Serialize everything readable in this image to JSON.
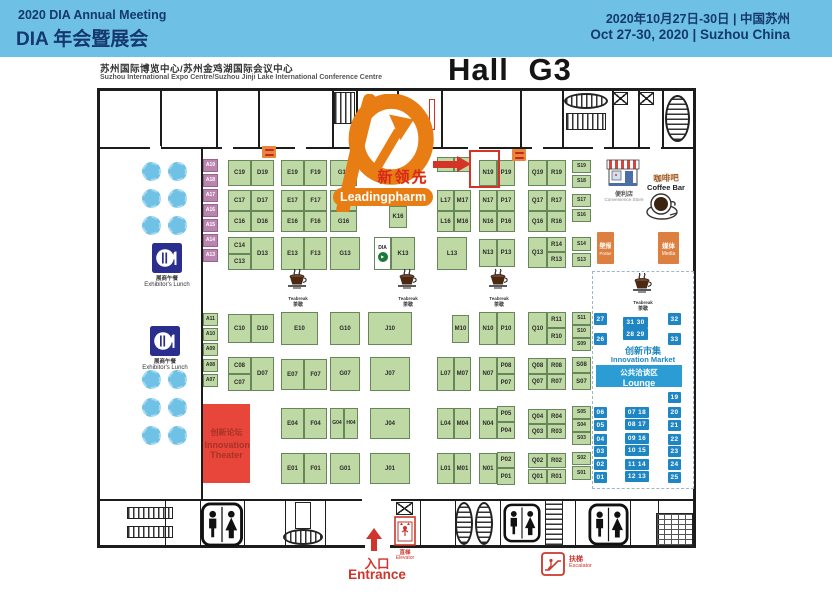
{
  "header": {
    "title_en": "2020 DIA Annual Meeting",
    "title_cn": "DIA 年会暨展会",
    "date_cn": "2020年10月27日-30日 | 中国苏州",
    "date_en": "Oct 27-30, 2020 | Suzhou China",
    "bg_color": "#6EC1E4",
    "text_color": "#14386F"
  },
  "venue": {
    "line_cn": "苏州国际博览中心/苏州金鸡湖国际会议中心",
    "line_en": "Suzhou International Expo Centre/Suzhou Jinji Lake International Conference Centre",
    "hall": "Hall G3"
  },
  "logo": {
    "brand_cn": "新领先",
    "brand_en": "Leadingpharm",
    "accent": "#E87D13"
  },
  "highlight_booth": "N19",
  "labels": {
    "lunch_cn": "展商午餐",
    "lunch_en": "Exhibitor's Lunch",
    "teabreak_en": "Teabreak",
    "teabreak_cn": "茶歇",
    "store_cn": "便利店",
    "store_en": "Convenience Store",
    "coffee_cn": "咖啡吧",
    "coffee_en": "Coffee Bar",
    "poster_cn": "壁报",
    "poster_en": "Poster",
    "media_cn": "媒体",
    "media_en": "Media",
    "market_cn": "创新市集",
    "market_en": "Innovation Market",
    "lounge_cn": "公共洽谈区",
    "lounge_en": "Lounge",
    "theater_cn": "创新论坛",
    "theater_en": "Innovation Theater",
    "entrance_cn": "入口",
    "entrance_en": "Entrance",
    "elevator_cn": "直梯",
    "elevator_en": "Elevator",
    "escalator_cn": "扶梯",
    "escalator_en": "Escalator"
  },
  "colors": {
    "booth_green": "#BED9A4",
    "booth_purple": "#BA85B0",
    "stall_blue": "#1E86C2",
    "lounge_blue": "#2C9DD4",
    "service_orange": "#DD7F3F",
    "theater_red": "#E8463B",
    "annotation_red": "#D63327"
  },
  "booths": [
    [
      "A19",
      203,
      159,
      15,
      13,
      "p"
    ],
    [
      "A18",
      203,
      174,
      15,
      13,
      "p"
    ],
    [
      "A17",
      203,
      189,
      15,
      13,
      "p"
    ],
    [
      "A16",
      203,
      204,
      15,
      13,
      "p"
    ],
    [
      "A15",
      203,
      219,
      15,
      13,
      "p"
    ],
    [
      "A14",
      203,
      234,
      15,
      13,
      "p"
    ],
    [
      "A13",
      203,
      249,
      15,
      13,
      "p"
    ],
    [
      "A11",
      203,
      313,
      15,
      13
    ],
    [
      "A10",
      203,
      328,
      15,
      13
    ],
    [
      "A09",
      203,
      343,
      15,
      13
    ],
    [
      "A08",
      203,
      359,
      15,
      13
    ],
    [
      "A07",
      203,
      374,
      15,
      13
    ],
    [
      "C19",
      228,
      160,
      23,
      26
    ],
    [
      "D19",
      251,
      160,
      23,
      26
    ],
    [
      "E19",
      281,
      160,
      23,
      26
    ],
    [
      "F19",
      304,
      160,
      23,
      26
    ],
    [
      "G19",
      330,
      160,
      27,
      26
    ],
    [
      "",
      437,
      157,
      17,
      15
    ],
    [
      "",
      454,
      157,
      17,
      15
    ],
    [
      "N19",
      479,
      160,
      18,
      26
    ],
    [
      "P19",
      497,
      160,
      18,
      26
    ],
    [
      "Q19",
      528,
      160,
      19,
      26
    ],
    [
      "R19",
      547,
      160,
      19,
      26
    ],
    [
      "S19",
      572,
      160,
      19,
      13
    ],
    [
      "S18",
      572,
      175,
      19,
      13
    ],
    [
      "S17",
      572,
      194,
      19,
      13
    ],
    [
      "S16",
      572,
      209,
      19,
      13
    ],
    [
      "C17",
      228,
      190,
      23,
      21
    ],
    [
      "D17",
      251,
      190,
      23,
      21
    ],
    [
      "C16",
      228,
      211,
      23,
      21
    ],
    [
      "D16",
      251,
      211,
      23,
      21
    ],
    [
      "E17",
      281,
      190,
      23,
      21
    ],
    [
      "F17",
      304,
      190,
      23,
      21
    ],
    [
      "E16",
      281,
      211,
      23,
      21
    ],
    [
      "F16",
      304,
      211,
      23,
      21
    ],
    [
      "",
      330,
      190,
      27,
      21
    ],
    [
      "G16",
      330,
      211,
      27,
      21
    ],
    [
      "K16",
      389,
      206,
      18,
      22
    ],
    [
      "L17",
      437,
      190,
      17,
      21
    ],
    [
      "M17",
      454,
      190,
      17,
      21
    ],
    [
      "L16",
      437,
      211,
      17,
      21
    ],
    [
      "M16",
      454,
      211,
      17,
      21
    ],
    [
      "N17",
      479,
      190,
      18,
      21
    ],
    [
      "P17",
      497,
      190,
      18,
      21
    ],
    [
      "N16",
      479,
      211,
      18,
      21
    ],
    [
      "P16",
      497,
      211,
      18,
      21
    ],
    [
      "Q17",
      528,
      190,
      19,
      21
    ],
    [
      "R17",
      547,
      190,
      19,
      21
    ],
    [
      "Q16",
      528,
      211,
      19,
      21
    ],
    [
      "R16",
      547,
      211,
      19,
      21
    ],
    [
      "C14",
      228,
      237,
      23,
      17
    ],
    [
      "C13",
      228,
      254,
      23,
      16
    ],
    [
      "D13",
      251,
      237,
      23,
      33
    ],
    [
      "E13",
      281,
      237,
      23,
      33
    ],
    [
      "F13",
      304,
      237,
      23,
      33
    ],
    [
      "G13",
      330,
      237,
      30,
      33
    ],
    [
      "DIA",
      374,
      237,
      17,
      33,
      "dia"
    ],
    [
      "K13",
      391,
      237,
      24,
      33
    ],
    [
      "L13",
      437,
      237,
      30,
      33
    ],
    [
      "N13",
      479,
      239,
      18,
      28
    ],
    [
      "P13",
      497,
      239,
      18,
      28
    ],
    [
      "Q13",
      528,
      237,
      19,
      31
    ],
    [
      "R14",
      547,
      237,
      19,
      15
    ],
    [
      "R13",
      547,
      252,
      19,
      16
    ],
    [
      "S14",
      572,
      237,
      19,
      14
    ],
    [
      "S13",
      572,
      253,
      19,
      14
    ],
    [
      "C10",
      228,
      314,
      23,
      29
    ],
    [
      "D10",
      251,
      314,
      23,
      29
    ],
    [
      "E10",
      281,
      312,
      37,
      33
    ],
    [
      "G10",
      330,
      312,
      30,
      33
    ],
    [
      "J10",
      368,
      312,
      44,
      33
    ],
    [
      "M10",
      452,
      315,
      17,
      28
    ],
    [
      "N10",
      479,
      312,
      18,
      33
    ],
    [
      "P10",
      497,
      312,
      18,
      33
    ],
    [
      "Q10",
      528,
      312,
      19,
      33
    ],
    [
      "R11",
      547,
      312,
      19,
      16
    ],
    [
      "R10",
      547,
      328,
      19,
      17
    ],
    [
      "S11",
      572,
      312,
      19,
      13
    ],
    [
      "S10",
      572,
      325,
      19,
      13
    ],
    [
      "S09",
      572,
      338,
      19,
      13
    ],
    [
      "C08",
      228,
      357,
      23,
      17
    ],
    [
      "C07",
      228,
      374,
      23,
      17
    ],
    [
      "D07",
      251,
      357,
      23,
      34
    ],
    [
      "E07",
      281,
      359,
      23,
      31
    ],
    [
      "F07",
      304,
      359,
      23,
      31
    ],
    [
      "G07",
      330,
      357,
      30,
      34
    ],
    [
      "J07",
      370,
      357,
      40,
      34
    ],
    [
      "L07",
      437,
      357,
      17,
      34
    ],
    [
      "M07",
      454,
      357,
      17,
      34
    ],
    [
      "N07",
      479,
      357,
      18,
      34
    ],
    [
      "P08",
      497,
      357,
      18,
      17
    ],
    [
      "P07",
      497,
      374,
      18,
      17
    ],
    [
      "Q08",
      528,
      358,
      19,
      16
    ],
    [
      "R08",
      547,
      358,
      19,
      16
    ],
    [
      "Q07",
      528,
      374,
      19,
      16
    ],
    [
      "R07",
      547,
      374,
      19,
      16
    ],
    [
      "S08",
      572,
      357,
      19,
      16
    ],
    [
      "S07",
      572,
      373,
      19,
      17
    ],
    [
      "E04",
      281,
      408,
      23,
      31
    ],
    [
      "F04",
      304,
      408,
      23,
      31
    ],
    [
      "G04",
      330,
      408,
      14,
      31
    ],
    [
      "H04",
      344,
      408,
      14,
      31
    ],
    [
      "J04",
      370,
      408,
      40,
      31
    ],
    [
      "L04",
      437,
      408,
      17,
      31
    ],
    [
      "M04",
      454,
      408,
      17,
      31
    ],
    [
      "N04",
      479,
      408,
      18,
      31
    ],
    [
      "P05",
      497,
      406,
      18,
      16
    ],
    [
      "P04",
      497,
      422,
      18,
      17
    ],
    [
      "Q04",
      528,
      409,
      19,
      15
    ],
    [
      "R04",
      547,
      409,
      19,
      15
    ],
    [
      "Q03",
      528,
      424,
      19,
      15
    ],
    [
      "R03",
      547,
      424,
      19,
      15
    ],
    [
      "S05",
      572,
      406,
      19,
      13
    ],
    [
      "S04",
      572,
      419,
      19,
      13
    ],
    [
      "S03",
      572,
      432,
      19,
      13
    ],
    [
      "E01",
      281,
      453,
      23,
      31
    ],
    [
      "F01",
      304,
      453,
      23,
      31
    ],
    [
      "G01",
      330,
      453,
      30,
      31
    ],
    [
      "J01",
      370,
      453,
      40,
      31
    ],
    [
      "L01",
      437,
      453,
      17,
      31
    ],
    [
      "M01",
      454,
      453,
      17,
      31
    ],
    [
      "N01",
      479,
      453,
      18,
      31
    ],
    [
      "P02",
      497,
      452,
      18,
      16
    ],
    [
      "P01",
      497,
      468,
      18,
      17
    ],
    [
      "Q02",
      528,
      453,
      19,
      15
    ],
    [
      "R02",
      547,
      453,
      19,
      15
    ],
    [
      "Q01",
      528,
      469,
      19,
      15
    ],
    [
      "R01",
      547,
      469,
      19,
      15
    ],
    [
      "S02",
      572,
      452,
      19,
      13
    ],
    [
      "S01",
      572,
      466,
      19,
      14
    ]
  ],
  "market_stalls": [
    [
      "27",
      594,
      313,
      13,
      12
    ],
    [
      "26",
      594,
      333,
      13,
      12
    ],
    [
      "31 30",
      623,
      317,
      25,
      11
    ],
    [
      "28 29",
      623,
      328,
      25,
      12
    ],
    [
      "32",
      668,
      313,
      13,
      12
    ],
    [
      "33",
      668,
      333,
      13,
      12
    ],
    [
      "19",
      668,
      392,
      13,
      11
    ],
    [
      "06",
      594,
      407,
      13,
      11
    ],
    [
      "05",
      594,
      420,
      13,
      11
    ],
    [
      "04",
      594,
      434,
      13,
      11
    ],
    [
      "03",
      594,
      446,
      13,
      11
    ],
    [
      "02",
      594,
      459,
      13,
      11
    ],
    [
      "01",
      594,
      472,
      13,
      11
    ],
    [
      "07 18",
      625,
      407,
      24,
      11
    ],
    [
      "08 17",
      625,
      419,
      24,
      11
    ],
    [
      "09 16",
      625,
      433,
      24,
      11
    ],
    [
      "10 15",
      625,
      445,
      24,
      11
    ],
    [
      "11 14",
      625,
      459,
      24,
      11
    ],
    [
      "12 13",
      625,
      471,
      24,
      11
    ],
    [
      "20",
      668,
      407,
      13,
      11
    ],
    [
      "21",
      668,
      420,
      13,
      11
    ],
    [
      "22",
      668,
      434,
      13,
      11
    ],
    [
      "23",
      668,
      446,
      13,
      11
    ],
    [
      "24",
      668,
      459,
      13,
      11
    ],
    [
      "25",
      668,
      472,
      13,
      11
    ]
  ],
  "tables": [
    [
      142,
      162
    ],
    [
      168,
      162
    ],
    [
      142,
      189
    ],
    [
      168,
      189
    ],
    [
      142,
      216
    ],
    [
      168,
      216
    ],
    [
      142,
      370
    ],
    [
      168,
      370
    ],
    [
      142,
      398
    ],
    [
      168,
      398
    ],
    [
      142,
      426
    ],
    [
      168,
      426
    ]
  ],
  "teabreaks": [
    [
      281,
      268
    ],
    [
      391,
      268
    ],
    [
      482,
      268
    ],
    [
      626,
      272
    ]
  ],
  "restrooms": [
    [
      200,
      502,
      44,
      45
    ],
    [
      503,
      501,
      38,
      44
    ],
    [
      588,
      502,
      41,
      45
    ]
  ],
  "lunches": [
    [
      152,
      243
    ],
    [
      150,
      326
    ]
  ],
  "markers": [
    [
      262,
      146
    ],
    [
      512,
      149
    ]
  ]
}
